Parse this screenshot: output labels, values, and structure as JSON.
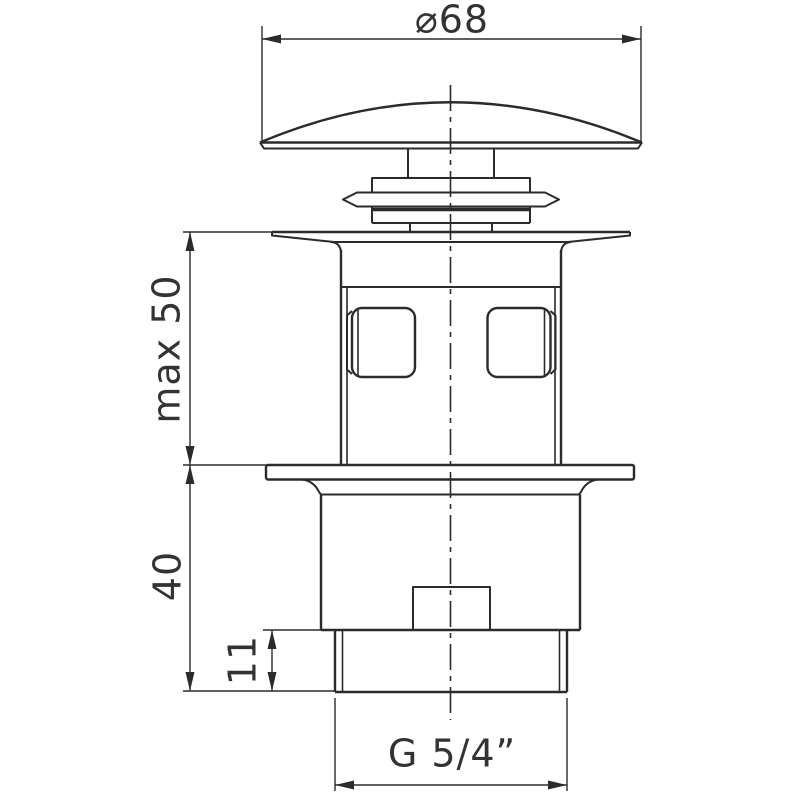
{
  "title": "Pop-up waste valve technical drawing",
  "colors": {
    "line": "#2b2b2b",
    "text": "#333333",
    "background": "#ffffff"
  },
  "dimensions": {
    "diameter_top": "⌀68",
    "max_height": "max 50",
    "lower_height": "40",
    "thread_length": "11",
    "thread_size": "G 5/4”"
  }
}
